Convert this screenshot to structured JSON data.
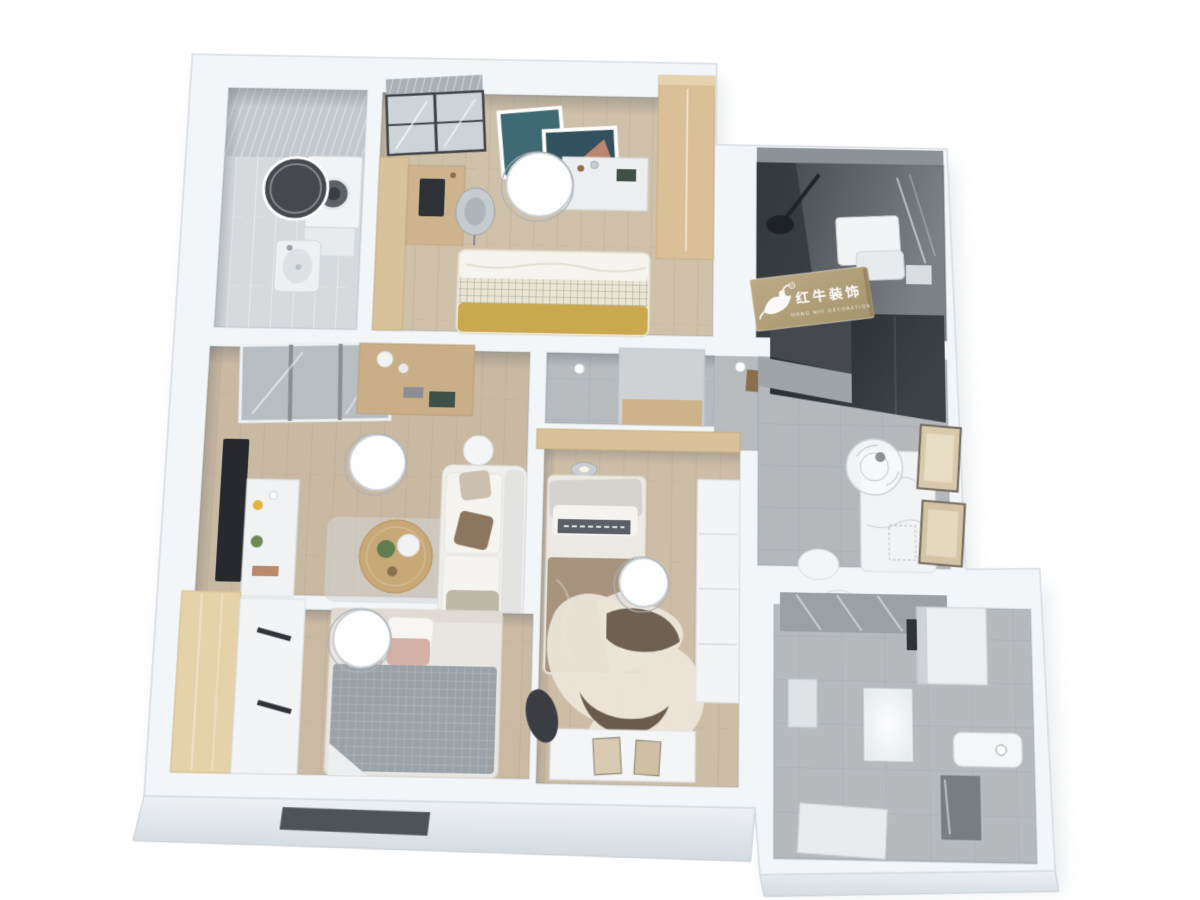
{
  "watermark": {
    "brand_cn": "红牛装饰",
    "brand_en": "HONG NIU DECORATION",
    "registered_mark": "R"
  },
  "palette": {
    "background": "#ffffff",
    "wall": "#f3f6f8",
    "wall_edge": "#d6dce2",
    "wood_floor": "#cdbda6",
    "gray_tile": "#b6babd",
    "laundry_tile": "#d7dadc",
    "dark_bathroom": "#4a4e52",
    "dark_cabinet": "#31363a",
    "wood_cabinet": "#d9c096",
    "plaque_tan": "#b3a07e",
    "mustard_blanket": "#c9a84e",
    "knit_blanket": "#9aa2a8",
    "duvet_brown": "#a8937e",
    "rug_cream": "#ebe5d8",
    "sofa_cream": "#efefed",
    "pink_pillow": "#d9b9ae"
  }
}
